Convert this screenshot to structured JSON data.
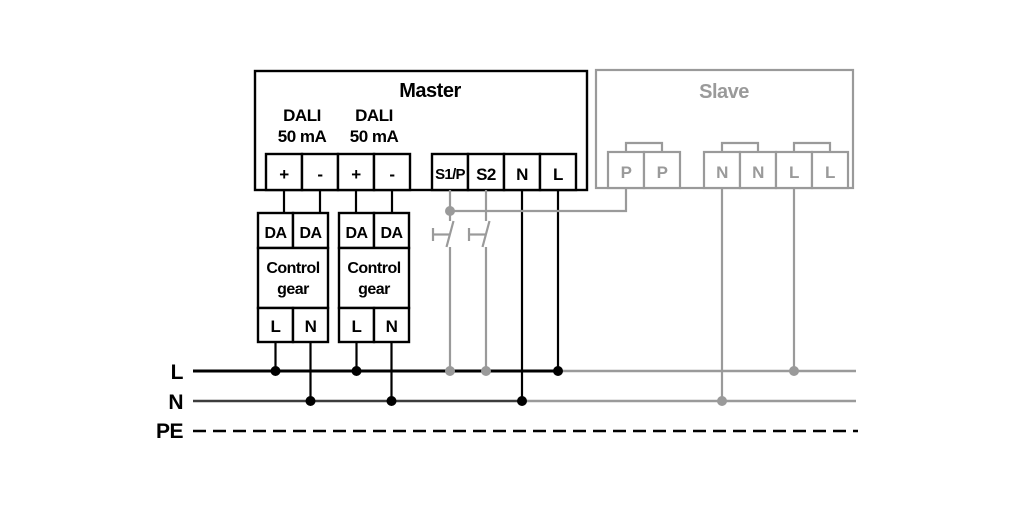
{
  "master": {
    "title": "Master",
    "dali1_line1": "DALI",
    "dali1_line2": "50 mA",
    "dali2_line1": "DALI",
    "dali2_line2": "50 mA",
    "terminals": [
      "+",
      "-",
      "+",
      "-",
      "S1/P",
      "S2",
      "N",
      "L"
    ]
  },
  "slave": {
    "title": "Slave",
    "terminals": [
      "P",
      "P",
      "N",
      "N",
      "L",
      "L"
    ]
  },
  "control_gear_1": {
    "terminals_top": [
      "DA",
      "DA"
    ],
    "name_line1": "Control",
    "name_line2": "gear",
    "terminals_bottom": [
      "L",
      "N"
    ]
  },
  "control_gear_2": {
    "terminals_top": [
      "DA",
      "DA"
    ],
    "name_line1": "Control",
    "name_line2": "gear",
    "terminals_bottom": [
      "L",
      "N"
    ]
  },
  "power_bus": {
    "line_label": "L",
    "neutral_label": "N",
    "earth_label": "PE"
  },
  "colors": {
    "active_black": "#000000",
    "inactive_gray": "#9a9a9a",
    "neutral_bus_dark": "#3d3d3d"
  }
}
